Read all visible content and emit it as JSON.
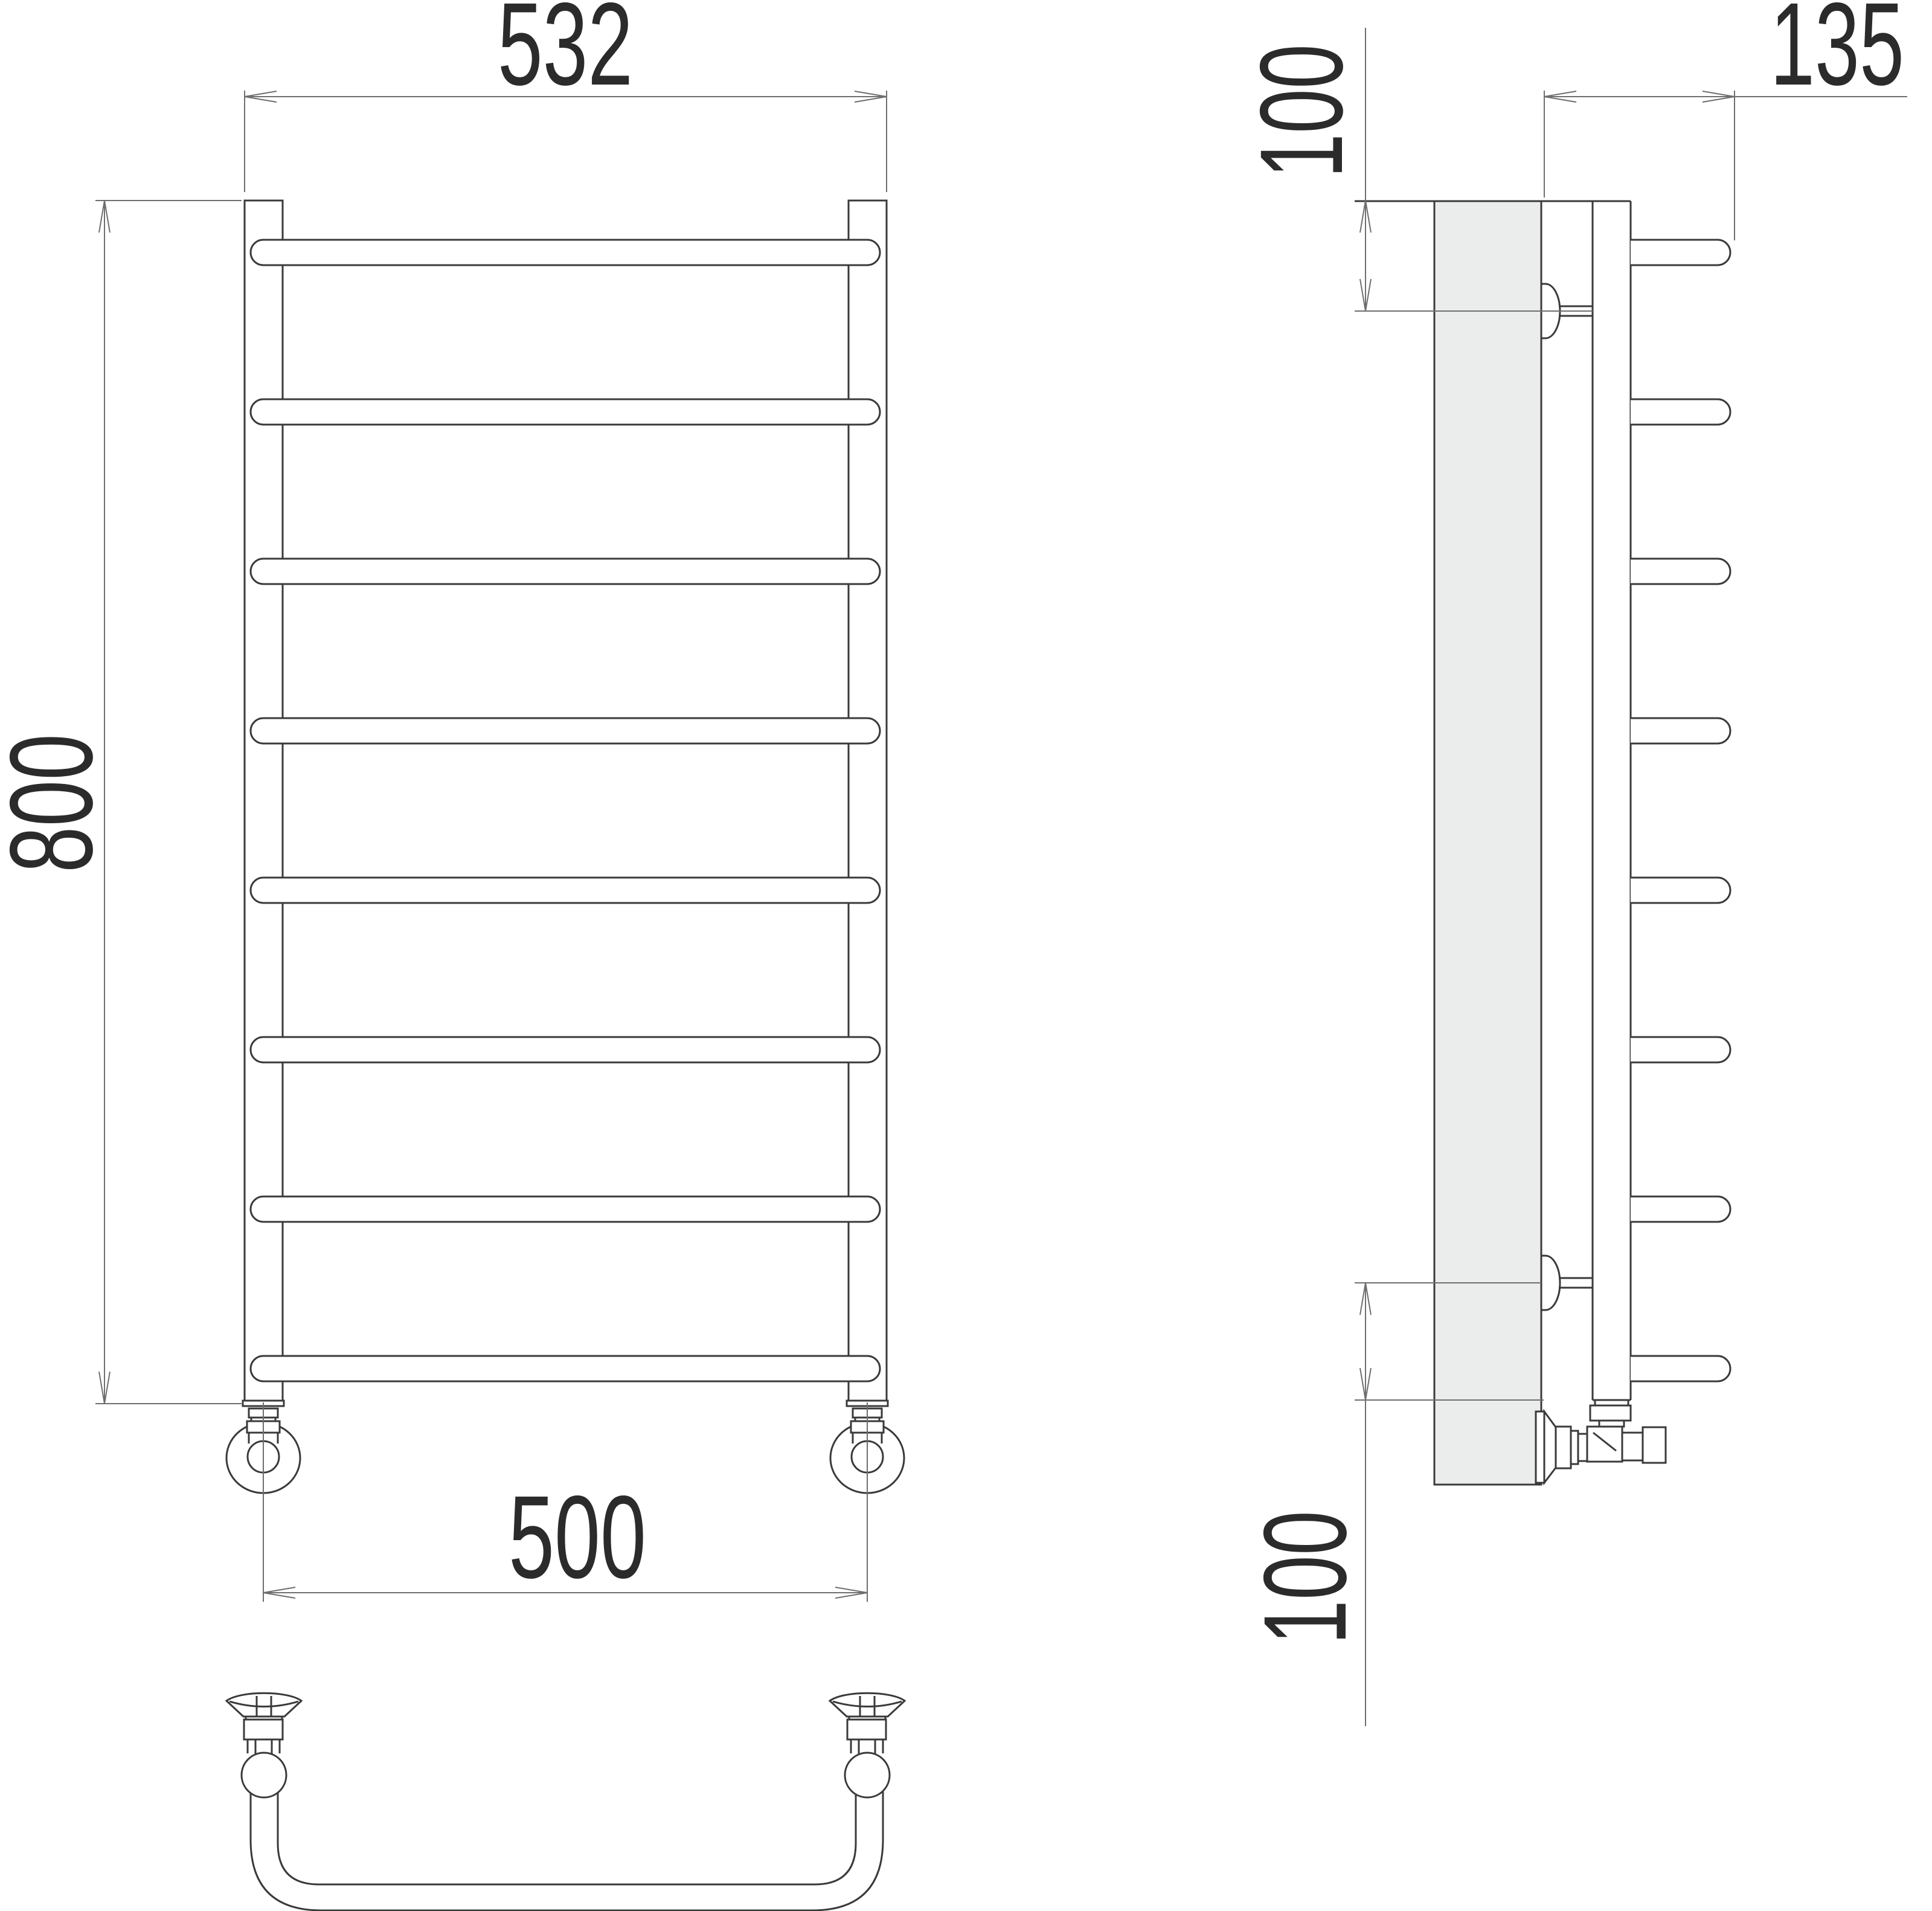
{
  "drawing": {
    "kind": "ladder-towel-rail-technical-drawing",
    "rung_count": 8,
    "colors": {
      "background": "#ffffff",
      "line": "#3a3a3a",
      "dimension_line": "#6e6e6e",
      "text": "#2b2b2b",
      "wall_fill": "#ebedec"
    }
  },
  "dimensions": {
    "overall_width": {
      "label": "532"
    },
    "overall_height": {
      "label": "800"
    },
    "connection_spacing": {
      "label": "500"
    },
    "depth": {
      "label": "135"
    },
    "top_bracket_offset": {
      "label": "100"
    },
    "bottom_bracket_offset": {
      "label": "100"
    }
  }
}
